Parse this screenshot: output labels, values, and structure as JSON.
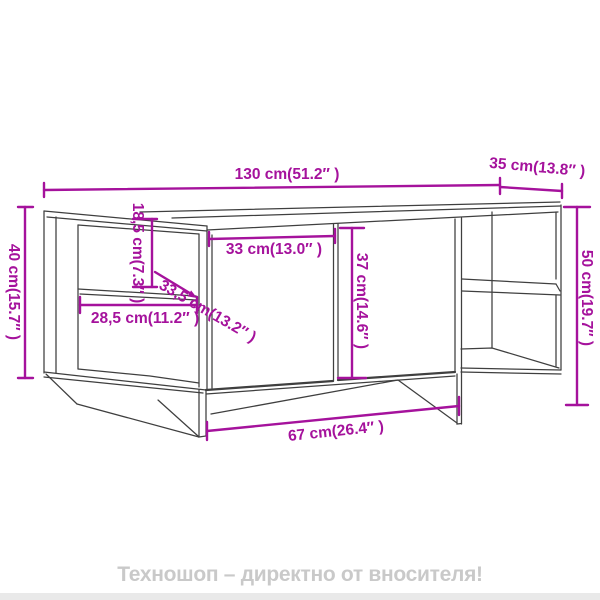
{
  "colors": {
    "dimension_accent": "#a5129c",
    "outline": "#3f3f3f",
    "footer_text": "#c9c9c9",
    "background": "#ffffff"
  },
  "dimensions": {
    "total_width": "130 cm(51.2″ )",
    "depth": "35 cm(13.8″ )",
    "left_height": "40 cm(15.7″ )",
    "right_height": "50 cm(19.7″ )",
    "upper_compartment_height": "18,5 cm(7.3″ )",
    "shelf_diagonal": "33,5 cm(13.2″ )",
    "shelf_depth": "28,5 cm(11.2″ )",
    "door_width": "33 cm(13.0″ )",
    "door_height": "37 cm(14.6″ )",
    "base_width": "67 cm(26.4″ )"
  },
  "footer": {
    "text": "Техношоп – директно от вносителя!"
  }
}
